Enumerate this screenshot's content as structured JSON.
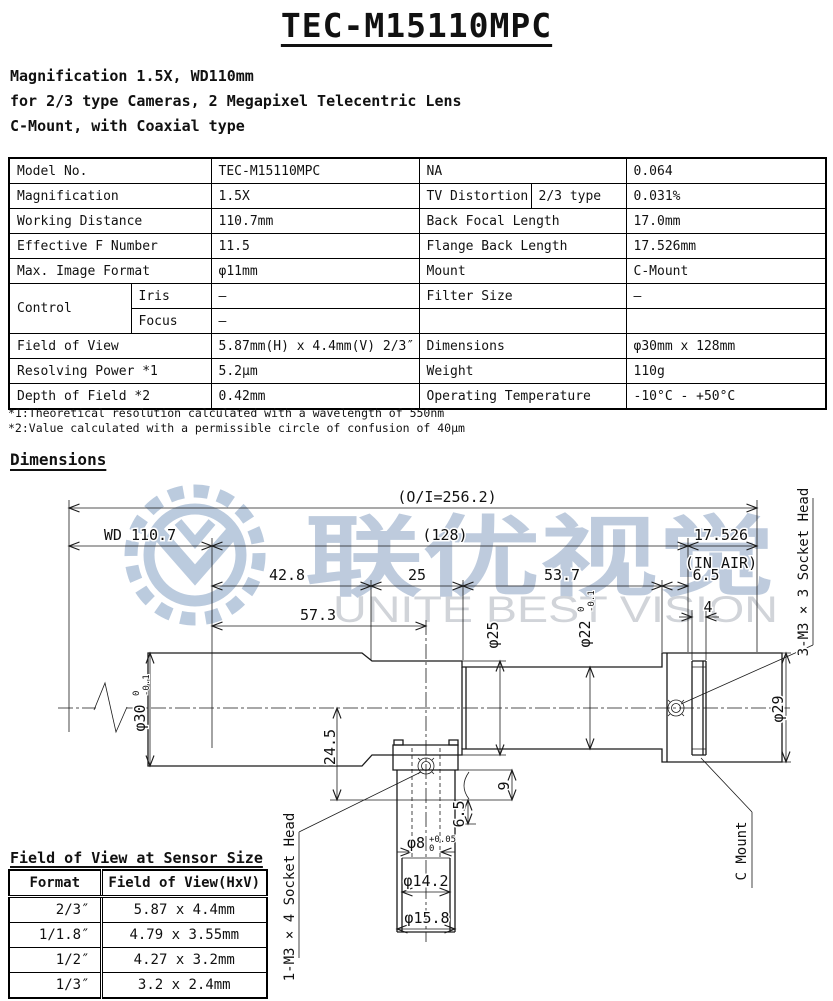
{
  "title": "TEC-M15110MPC",
  "subtitle_lines": [
    "Magnification 1.5X, WD110mm",
    "for 2/3 type Cameras, 2 Megapixel Telecentric Lens",
    "C-Mount, with Coaxial type"
  ],
  "spec": {
    "model_label": "Model No.",
    "model_value": "TEC-M15110MPC",
    "na_label": "NA",
    "na_value": "0.064",
    "mag_label": "Magnification",
    "mag_value": "1.5X",
    "tvd_label": "TV Distortion",
    "tvd_sub": "2/3 type",
    "tvd_value": "0.031%",
    "wd_label": "Working Distance",
    "wd_value": "110.7mm",
    "bfl_label": "Back Focal Length",
    "bfl_value": "17.0mm",
    "efn_label": "Effective F Number",
    "efn_value": "11.5",
    "fbl_label": "Flange Back Length",
    "fbl_value": "17.526mm",
    "mif_label": "Max. Image Format",
    "mif_value": "φ11mm",
    "mount_label": "Mount",
    "mount_value": "C-Mount",
    "control_label": "Control",
    "iris_label": "Iris",
    "iris_value": "–",
    "focus_label": "Focus",
    "focus_value": "–",
    "filter_label": "Filter Size",
    "filter_value": "–",
    "fov_label": "Field of View",
    "fov_value": "5.87mm(H) x 4.4mm(V) 2/3″",
    "dims_label": "Dimensions",
    "dims_value": "φ30mm x 128mm",
    "rp_label": "Resolving Power *1",
    "rp_value": "5.2μm",
    "weight_label": "Weight",
    "weight_value": "110g",
    "dof_label": "Depth of Field *2",
    "dof_value": "0.42mm",
    "temp_label": "Operating Temperature",
    "temp_value": "-10°C - +50°C"
  },
  "notes": [
    "*1:Theoretical resolution calculated with a wavelength of 550nm",
    "*2:Value calculated with a permissible circle of confusion of 40μm"
  ],
  "dimensions_heading": "Dimensions",
  "drawing": {
    "oi": "(O/I=256.2)",
    "wd": "WD 110.7",
    "mid": "(128)",
    "flange_back": "17.526",
    "in_air": "(IN AIR)",
    "d428": "42.8",
    "d25": "25",
    "d537": "53.7",
    "d65": "6.5",
    "d573": "57.3",
    "d4": "4",
    "dia30": "φ30",
    "dia30_tol_top": "0",
    "dia30_tol_bot": "-0.1",
    "d245": "24.5",
    "dia25": "φ25",
    "dia22": "φ22",
    "dia22_tol_top": "0",
    "dia22_tol_bot": "-0.1",
    "dia29": "φ29",
    "d9": "9",
    "d65b": "6.5",
    "dia8": "φ8",
    "dia8_tol_top": "+0.05",
    "dia8_tol_bot": "0",
    "dia142": "φ14.2",
    "dia158": "φ15.8",
    "socket3": "3-M3 × 3 Socket Head",
    "socket1": "1-M3 × 4 Socket Head",
    "cmount": "C Mount"
  },
  "watermark": {
    "cn": "联优视觉",
    "en": "UNITE BEST VISION",
    "accent_color": "#b3c3d8",
    "en_color": "#c9cdd3"
  },
  "fov_table": {
    "heading": "Field of View at Sensor Size",
    "col1": "Format",
    "col2": "Field of View(HxV)",
    "rows": [
      {
        "format": "2/3″",
        "fov": "5.87 x  4.4mm"
      },
      {
        "format": "1/1.8″",
        "fov": "4.79 x 3.55mm"
      },
      {
        "format": "1/2″",
        "fov": "4.27 x  3.2mm"
      },
      {
        "format": "1/3″",
        "fov": "3.2  x  2.4mm"
      }
    ]
  }
}
